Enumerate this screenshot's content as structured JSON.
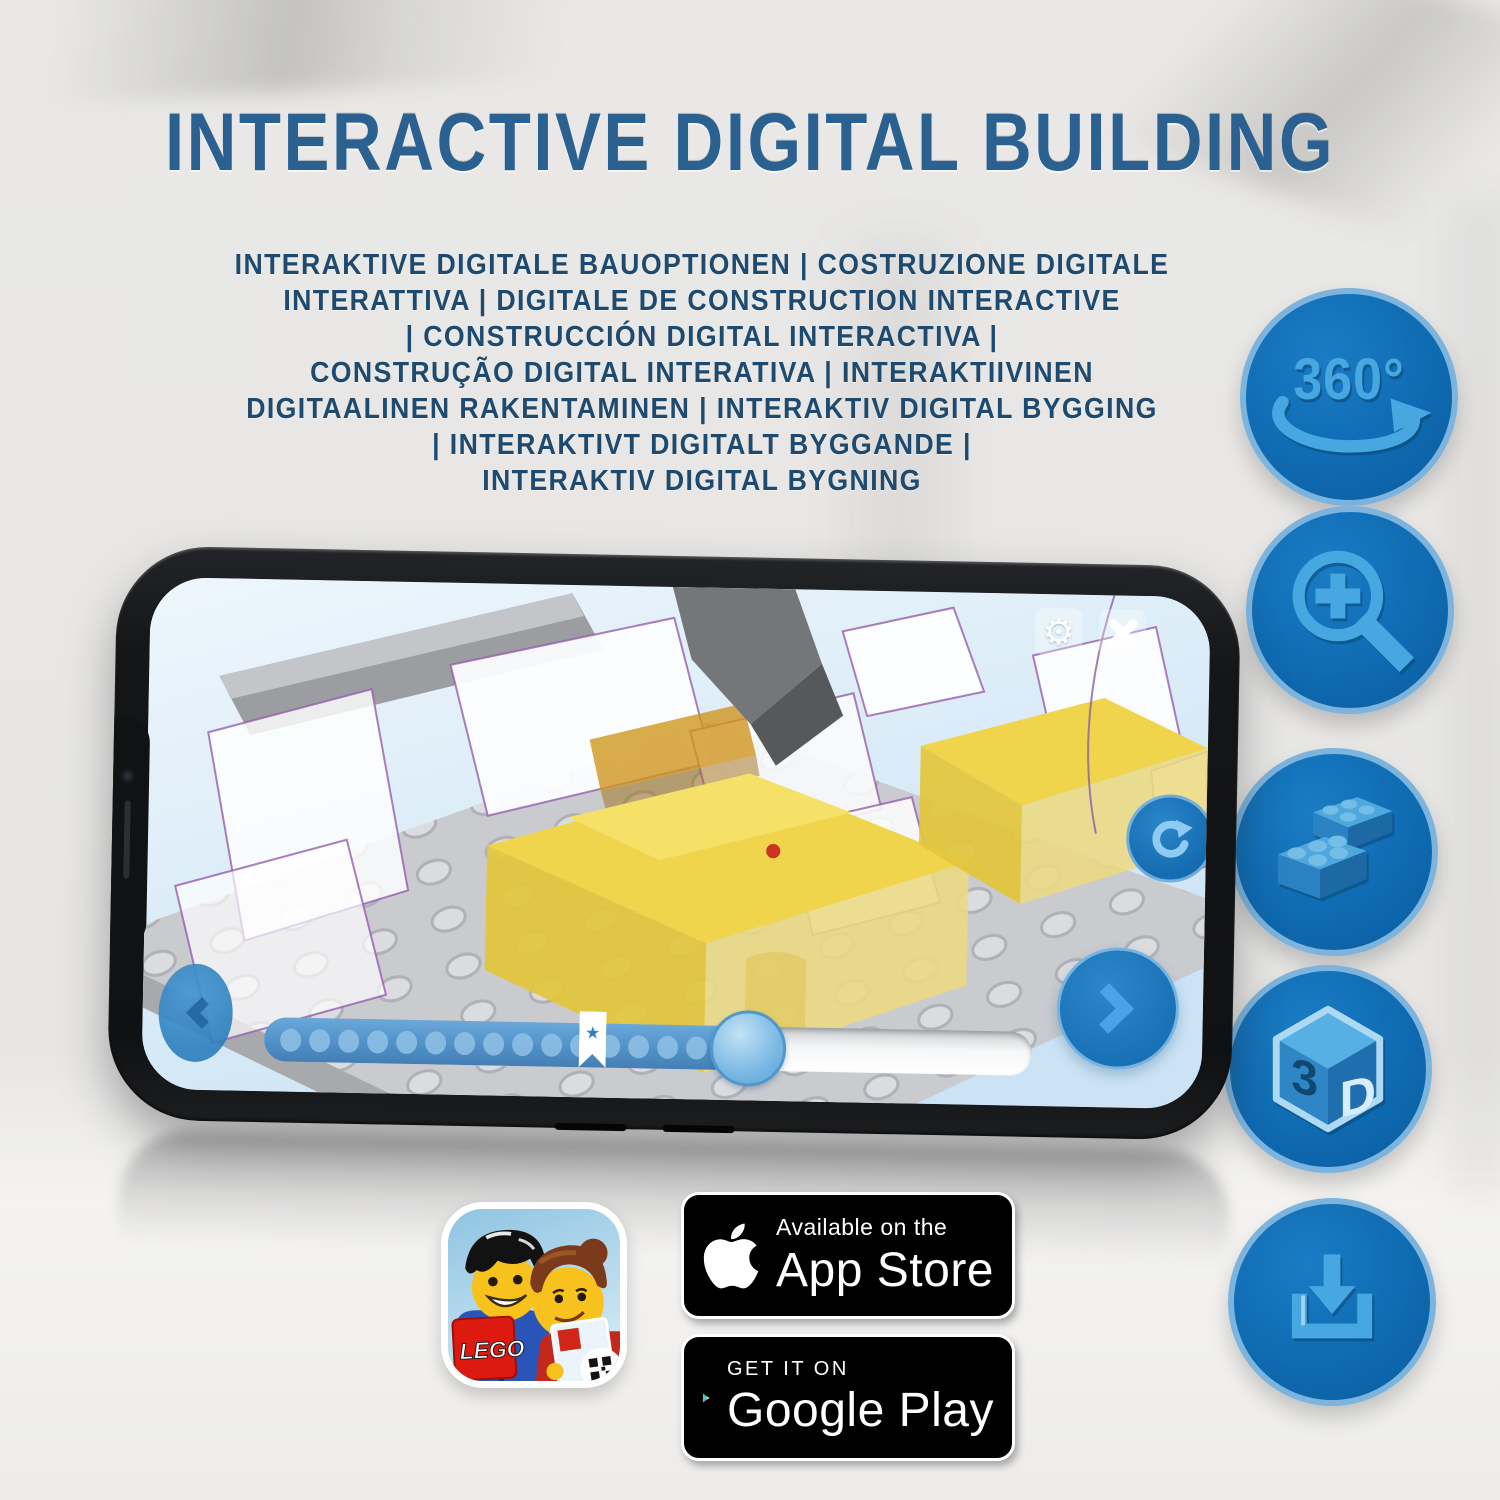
{
  "title": "INTERACTIVE DIGITAL BUILDING",
  "subtitle_lines": [
    "INTERAKTIVE DIGITALE BAUOPTIONEN | COSTRUZIONE DIGITALE",
    "INTERATTIVA | DIGITALE DE CONSTRUCTION INTERACTIVE",
    "| CONSTRUCCIÓN DIGITAL INTERACTIVA |",
    "CONSTRUÇÃO DIGITAL INTERATIVA | INTERAKTIIVINEN",
    "DIGITAALINEN RAKENTAMINEN | INTERAKTIV DIGITAL BYGGING",
    "| INTERAKTIVT DIGITALT BYGGANDE |",
    "INTERAKTIV DIGITAL BYGNING"
  ],
  "feature_icons": [
    {
      "name": "rotate-360-icon",
      "label": "360°"
    },
    {
      "name": "zoom-in-icon"
    },
    {
      "name": "brick-icon"
    },
    {
      "name": "3d-view-icon",
      "cube_left": "3",
      "cube_right": "D"
    },
    {
      "name": "download-icon"
    }
  ],
  "phone": {
    "app_ui": {
      "bookmark_star": "★",
      "progress": {
        "fraction": 0.63,
        "bookmark_fraction": 0.41,
        "steps_shown": 17
      }
    }
  },
  "badges": {
    "lego_app_icon": {
      "logo_text": "LEGO"
    },
    "app_store": {
      "tagline": "Available on the",
      "store": "App Store"
    },
    "google_play": {
      "tagline": "GET IT ON",
      "store": "Google Play"
    }
  },
  "colors": {
    "accent_blue": "#0f6bb2",
    "icon_light_blue": "#4aa6de",
    "title_blue": "#2a6191",
    "subtitle_navy": "#1d4a6e",
    "brick_yellow": "#efd44c",
    "screen_sky": "#d9ecf8"
  }
}
